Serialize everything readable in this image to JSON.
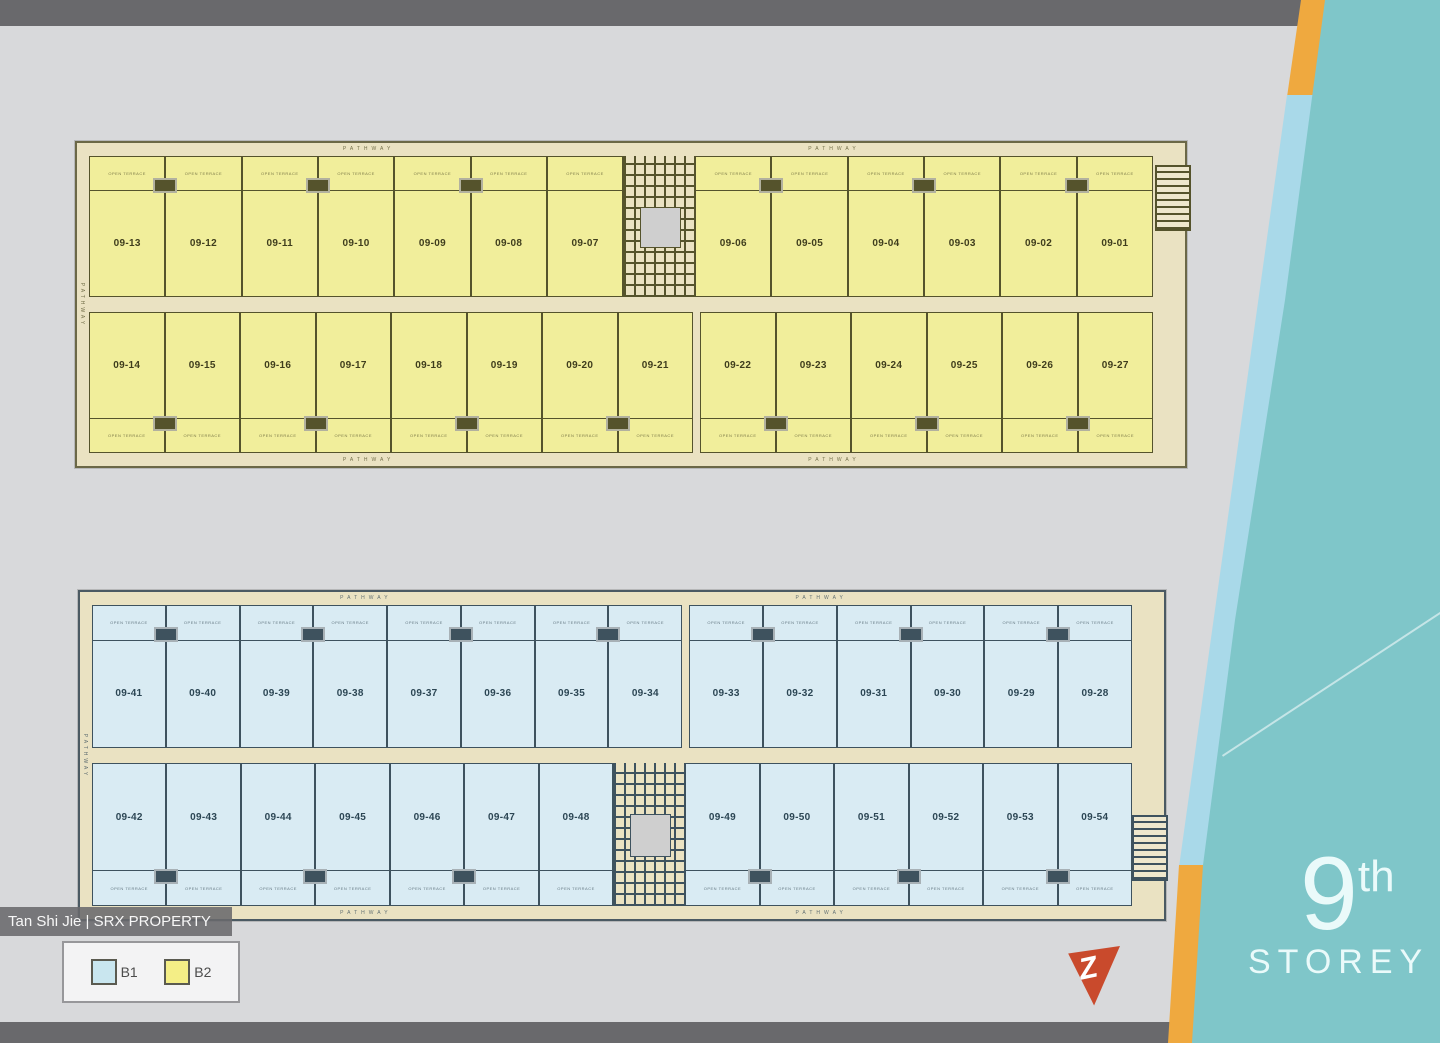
{
  "watermark": "Tan Shi Jie | SRX PROPERTY",
  "storey": {
    "number": "9",
    "suffix": "th",
    "word": "STOREY"
  },
  "pathway_label": "PATHWAY",
  "terrace_label": "OPEN TERRACE",
  "logo_letter": "Z",
  "legend": {
    "items": [
      {
        "label": "B1",
        "color": "#c9e6ef"
      },
      {
        "label": "B2",
        "color": "#f4ee86"
      }
    ]
  },
  "palette": {
    "bg": "#d8d9db",
    "bar_gray": "#69696c",
    "cream": "#eae2c2",
    "teal": "#7fc6c9",
    "edge_blue": "#a9d9e9",
    "edge_orange": "#efa93f"
  },
  "blocks": [
    {
      "name": "B2",
      "fill": "#f1ee9b",
      "line": "#55532c",
      "text": "#3f3d1d",
      "border": "#6b6847",
      "rows": [
        {
          "segments": [
            {
              "type": "units",
              "labels": [
                "09-13",
                "09-12",
                "09-11",
                "09-10",
                "09-09",
                "09-08",
                "09-07"
              ]
            },
            {
              "type": "core"
            },
            {
              "type": "units",
              "labels": [
                "09-06",
                "09-05",
                "09-04",
                "09-03",
                "09-02",
                "09-01"
              ]
            }
          ]
        },
        {
          "segments": [
            {
              "type": "units",
              "labels": [
                "09-14",
                "09-15",
                "09-16",
                "09-17",
                "09-18",
                "09-19",
                "09-20",
                "09-21"
              ]
            },
            {
              "type": "gap"
            },
            {
              "type": "units",
              "labels": [
                "09-22",
                "09-23",
                "09-24",
                "09-25",
                "09-26",
                "09-27"
              ]
            }
          ]
        }
      ]
    },
    {
      "name": "B1",
      "fill": "#d9ebf3",
      "line": "#3e525e",
      "text": "#2c4654",
      "border": "#4b5a63",
      "rows": [
        {
          "segments": [
            {
              "type": "units",
              "labels": [
                "09-41",
                "09-40",
                "09-39",
                "09-38",
                "09-37",
                "09-36",
                "09-35",
                "09-34"
              ]
            },
            {
              "type": "gap"
            },
            {
              "type": "units",
              "labels": [
                "09-33",
                "09-32",
                "09-31",
                "09-30",
                "09-29",
                "09-28"
              ]
            }
          ]
        },
        {
          "segments": [
            {
              "type": "units",
              "labels": [
                "09-42",
                "09-43",
                "09-44",
                "09-45",
                "09-46",
                "09-47",
                "09-48"
              ]
            },
            {
              "type": "core"
            },
            {
              "type": "units",
              "labels": [
                "09-49",
                "09-50",
                "09-51",
                "09-52",
                "09-53",
                "09-54"
              ]
            }
          ]
        }
      ]
    }
  ]
}
